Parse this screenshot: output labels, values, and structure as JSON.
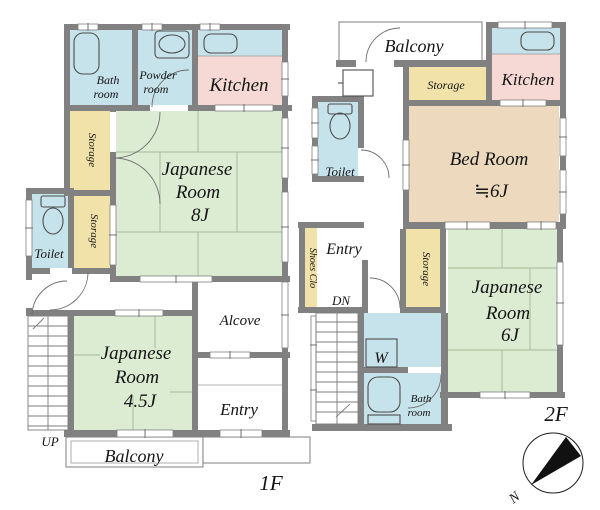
{
  "palette": {
    "wall_gray": "#818181",
    "water_blue": "#c6e3eb",
    "kitchen_pink": "#f6d8d4",
    "tatami_green": "#dcecd2",
    "storage_yellow": "#f1e2a9",
    "bedroom_tan": "#edd9bd"
  },
  "floor1": {
    "tag": "1F",
    "bath_l1": "Bath",
    "bath_l2": "room",
    "powder_l1": "Powder",
    "powder_l2": "room",
    "kitchen": "Kitchen",
    "storage_upper": "Storage",
    "storage_lower": "Storage",
    "toilet": "Toilet",
    "jroom8_l1": "Japanese",
    "jroom8_l2": "Room",
    "jroom8_l3": "8J",
    "jroom45_l1": "Japanese",
    "jroom45_l2": "Room",
    "jroom45_l3": "4.5J",
    "alcove": "Alcove",
    "entry": "Entry",
    "balcony": "Balcony",
    "up": "UP"
  },
  "floor2": {
    "tag": "2F",
    "balcony": "Balcony",
    "kitchen": "Kitchen",
    "storage_top": "Storage",
    "bed_l1": "Bed Room",
    "bed_l2": "≒6J",
    "toilet": "Toilet",
    "entry": "Entry",
    "shoes_closet": "Shoes Clo",
    "dn": "DN",
    "storage_side": "Storage",
    "jroom6_l1": "Japanese",
    "jroom6_l2": "Room",
    "jroom6_l3": "6J",
    "washer": "W",
    "bath_l1": "Bath",
    "bath_l2": "room"
  },
  "compass": {
    "north": "N"
  }
}
